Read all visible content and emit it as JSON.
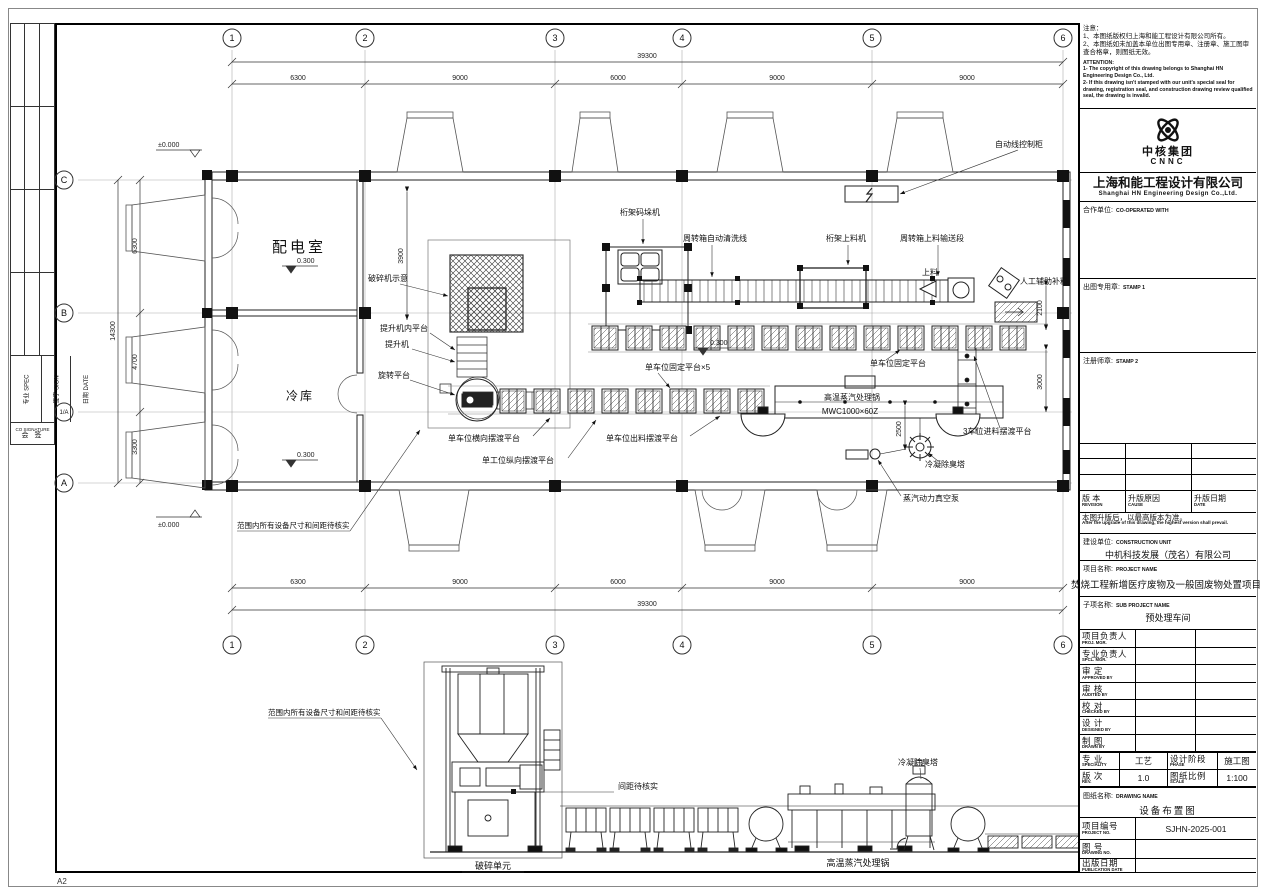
{
  "sheet": {
    "format": "A2"
  },
  "left_strip": {
    "spec": "专业 SPEC",
    "sign": "签字 SIGN",
    "date": "日期 DATE",
    "co_en": "CO SIGNATURE",
    "co_cn": "会 签"
  },
  "titleblock": {
    "notes_cn": {
      "title": "注意：",
      "line1": "1、本图纸版权归上海和能工程设计有限公司所有。",
      "line2": "2、本图纸如未加盖本单位出图专用章、注册章、施工图审查合格章，则图纸无效。"
    },
    "notes_en": {
      "title": "ATTENTION:",
      "line1": "1- The copyright of this drawing belongs to Shanghai HN Engineering Design Co., Ltd.",
      "line2": "2- If this drawing isn't stamped with our unit's special seal for drawing, registration seal, and construction drawing review qualified seal, the drawing is invalid."
    },
    "logo": {
      "cn": "中核集团",
      "en": "CNNC"
    },
    "company": {
      "cn": "上海和能工程设计有限公司",
      "en": "Shanghai HN Engineering Design Co.,Ltd."
    },
    "coop": {
      "label_cn": "合作单位:",
      "label_en": "CO-OPERATED WITH"
    },
    "stamp1": {
      "label_cn": "出图专用章:",
      "label_en": "STAMP 1"
    },
    "stamp2": {
      "label_cn": "注册师章:",
      "label_en": "STAMP 2"
    },
    "revision": {
      "rev_cn": "版 本",
      "rev_en": "REVISION",
      "cause_cn": "升版原因",
      "cause_en": "CAUSE",
      "date_cn": "升版日期",
      "date_en": "DATE"
    },
    "upgrade_cn": "本图升版后，以最高版本为准。",
    "upgrade_en": "After the upgrade of this drawing, the highest version shall prevail.",
    "construction": {
      "label_cn": "建设单位:",
      "label_en": "CONSTRUCTION UNIT",
      "value": "中机科技发展（茂名）有限公司"
    },
    "project": {
      "label_cn": "项目名称:",
      "label_en": "PROJECT NAME",
      "value": "焚烧工程新增医疗废物及一般固废物处置项目"
    },
    "subproject": {
      "label_cn": "子项名称:",
      "label_en": "SUB PROJECT NAME",
      "value": "预处理车间"
    },
    "personnel": [
      {
        "cn": "项目负责人",
        "en": "PROJ. MGR."
      },
      {
        "cn": "专业负责人",
        "en": "SPCL. MGR."
      },
      {
        "cn": "审 定",
        "en": "APPROVED BY"
      },
      {
        "cn": "审 核",
        "en": "AUDITED BY"
      },
      {
        "cn": "校 对",
        "en": "CHECKED BY"
      },
      {
        "cn": "设 计",
        "en": "DESIGNED BY"
      },
      {
        "cn": "制 图",
        "en": "DRAWN BY"
      }
    ],
    "spec_row": {
      "cn": "专 业",
      "en": "SPECIALITY",
      "value": "工艺",
      "phase_cn": "设计阶段",
      "phase_en": "PHASE",
      "phase_value": "施工图"
    },
    "rev_row": {
      "cn": "版 次",
      "en": "REV.",
      "value": "1.0",
      "scale_cn": "图纸比例",
      "scale_en": "SCALE",
      "scale_value": "1:100"
    },
    "drawing_name": {
      "label_cn": "图纸名称:",
      "label_en": "DRAWING NAME",
      "value": "设备布置图"
    },
    "project_no": {
      "cn": "项目编号",
      "en": "PROJECT NO.",
      "value": "SJHN-2025-001"
    },
    "drawing_no": {
      "cn": "图 号",
      "en": "DRAWING NO.",
      "value": ""
    },
    "pub_date": {
      "cn": "出版日期",
      "en": "PUBLICATION DATE",
      "value": ""
    }
  },
  "plan": {
    "grid_cols": [
      "1",
      "2",
      "3",
      "4",
      "5",
      "6"
    ],
    "grid_rows": [
      "C",
      "B",
      "1/A",
      "A"
    ],
    "dims_top": [
      "6300",
      "9000",
      "6000",
      "9000",
      "9000"
    ],
    "dims_total": "39300",
    "dims_left": [
      "6300",
      "4700",
      "3300"
    ],
    "dims_left_total": "14300",
    "d3900": "3900",
    "d2100": "2100",
    "d3000": "3000",
    "d2500": "2500",
    "levels": {
      "zero": "±0.000",
      "p300": "0.300"
    },
    "rooms": {
      "power": "配电室",
      "cold": "冷库"
    },
    "labels": {
      "crusher_schematic": "破碎机示意",
      "hoist_platform": "提升机内平台",
      "hoist": "提升机",
      "rotating_platform": "旋转平台",
      "truss_palletizer": "桁架码垛机",
      "washing_line": "周转箱自动清洗线",
      "truss_loader": "桁架上料机",
      "feed_conveyor": "周转箱上料输送段",
      "feeding": "上料",
      "manual_refill": "人工辅助补料",
      "control_cabinet": "自动线控制柜",
      "fixed_platform_x5": "单车位固定平台×5",
      "fixed_platform": "单车位固定平台",
      "discharge_ferry": "单车位出料摆渡平台",
      "lateral_ferry": "单车位横向摆渡平台",
      "longitudinal_ferry": "单工位纵向摆渡平台",
      "steam_pot": "高温蒸汽处理锅",
      "steam_pot_model": "MWC1000×60Z",
      "feed_ferry_3": "3车位进料摆渡平台",
      "condenser_tower": "冷凝除臭塔",
      "vacuum_pump": "蒸汽动力真空泵",
      "verify_note": "范围内所有设备尺寸和间距待核实"
    }
  },
  "elevation": {
    "labels": {
      "verify_note": "范围内所有设备尺寸和间距待核实",
      "spacing_note": "间距待核实",
      "crushing_unit": "破碎单元",
      "steam_pot": "高温蒸汽处理锅",
      "condenser_tower": "冷凝除臭塔"
    }
  }
}
